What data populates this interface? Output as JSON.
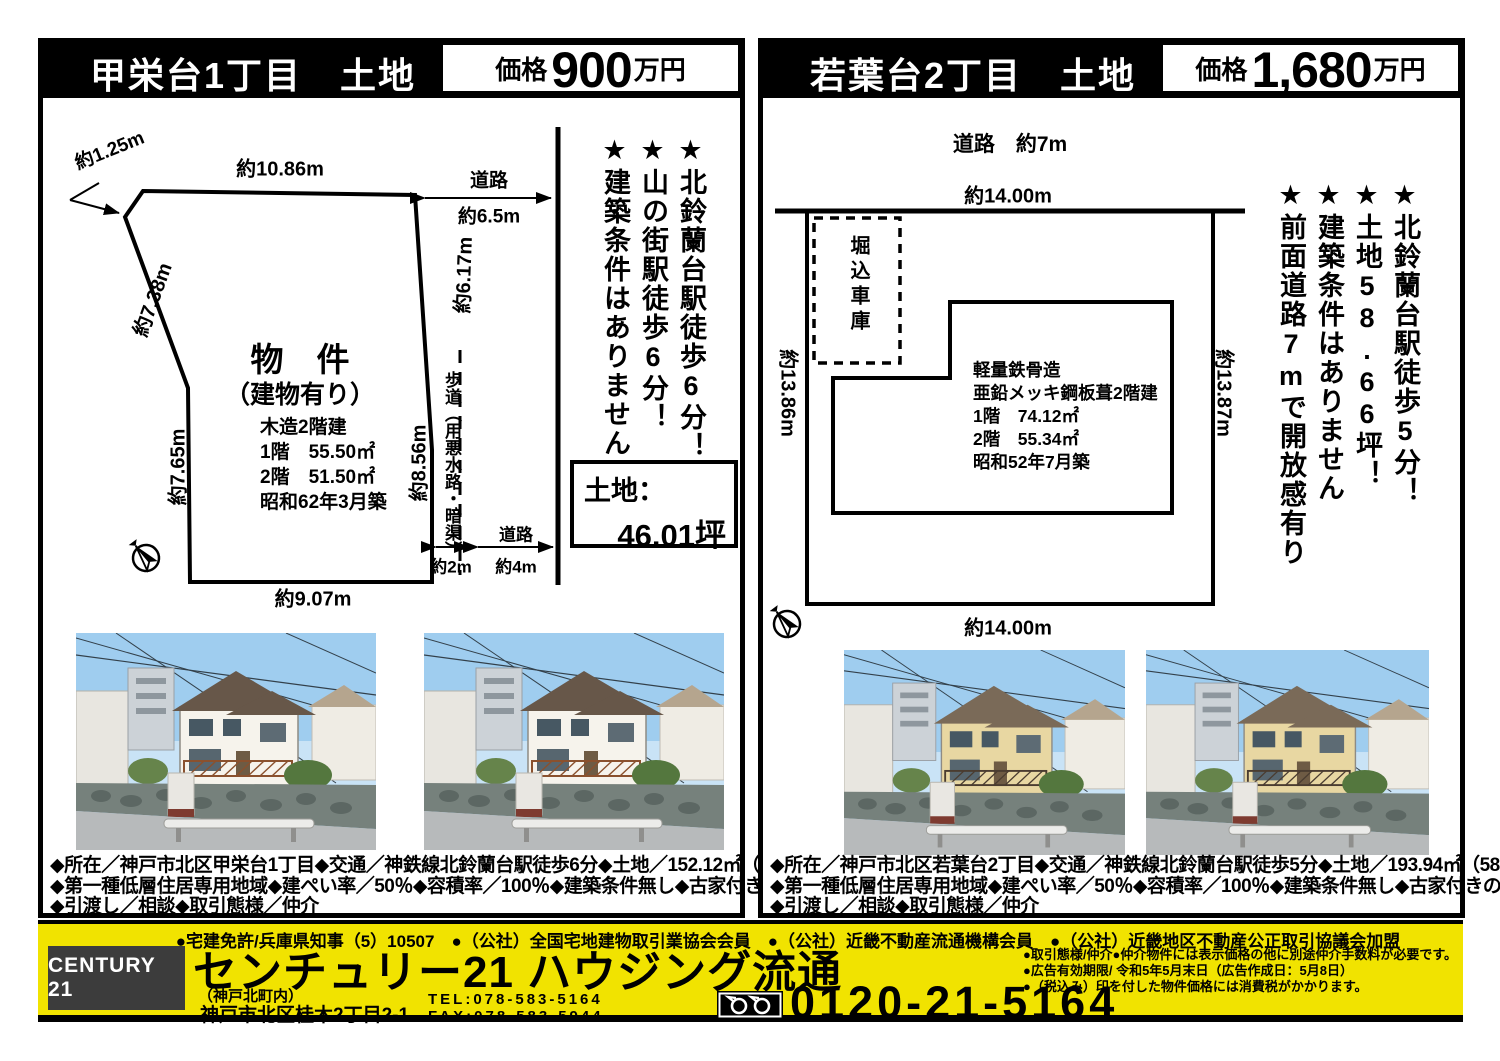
{
  "left_property": {
    "title": "甲栄台1丁目　土地",
    "price": {
      "label": "価格",
      "value": "900",
      "unit": "万円"
    },
    "diagram": {
      "top_width": "約10.86m",
      "corner_width": "約1.25m",
      "left_upper": "約7.38m",
      "left_lower": "約7.65m",
      "right_upper": "約6.17m",
      "right_lower": "約8.56m",
      "bottom_width": "約9.07m",
      "road_right_label": "道路",
      "road_right_width": "約6.5m",
      "sidewalk_label": "歩道（用悪水路・暗渠）",
      "sidewalk_width": "約2m",
      "road_bottom_label": "道路",
      "road_bottom_width": "約4m",
      "lot_title": "物　件",
      "lot_subtitle": "（建物有り）",
      "building_lines": [
        "木造2階建",
        "1階　55.50㎡",
        "2階　51.50㎡",
        "昭和62年3月築"
      ]
    },
    "highlights": [
      "★北鈴蘭台駅徒歩6分！",
      "★山の街駅徒歩6分！",
      "★建築条件はありません"
    ],
    "land_box": {
      "label": "土地：",
      "value": "46.01坪"
    },
    "photo_colors": {
      "house": "#f6f3ec",
      "roof": "#675749",
      "rail": "#8a512e"
    },
    "details": [
      "◆所在／神戸市北区甲栄台1丁目◆交通／神鉄線北鈴蘭台駅徒歩6分◆土地／152.12㎡（46.01坪）",
      "◆第一種低層住居専用地域◆建ぺい率／50％◆容積率／100％◆建築条件無し◆古家付きの引渡し",
      "◆引渡し／相談◆取引態様／仲介"
    ]
  },
  "right_property": {
    "title": "若葉台2丁目　土地",
    "price": {
      "label": "価格",
      "value": "1,680",
      "unit": "万円"
    },
    "diagram": {
      "road_top": "道路　約7m",
      "top_width": "約14.00m",
      "left_side": "約13.86m",
      "right_side": "約13.87m",
      "bottom_width": "約14.00m",
      "garage_label": "堀込車庫",
      "building_lines": [
        "軽量鉄骨造",
        "亜鉛メッキ鋼板葺2階建",
        "1階　74.12㎡",
        "2階　55.34㎡",
        "昭和52年7月築"
      ]
    },
    "highlights": [
      "★北鈴蘭台駅徒歩5分！",
      "★土地58.66坪！",
      "★建築条件はありません",
      "★前面道路7mで開放感有り"
    ],
    "photo_colors": {
      "house": "#e8d7a2",
      "roof": "#7a6a58",
      "rail": "#4a3c30"
    },
    "details": [
      "◆所在／神戸市北区若葉台2丁目◆交通／神鉄線北鈴蘭台駅徒歩5分◆土地／193.94㎡（58.66坪）",
      "◆第一種低層住居専用地域◆建ぺい率／50％◆容積率／100％◆建築条件無し◆古家付きの引渡し",
      "◆引渡し／相談◆取引態様／仲介"
    ]
  },
  "footer": {
    "memberships": "●宅建免許/兵庫県知事（5）10507　●（公社）全国宅地建物取引業協会会員　●（公社）近畿不動産流通機構会員　●（公社）近畿地区不動産公正取引協議会加盟",
    "logo": "CENTURY 21",
    "company": "センチュリー21 ハウジング流通",
    "branch": "（神戸北町内）",
    "address": "神戸市北区桂木2丁目2-1",
    "tel": "TEL:078-583-5164",
    "fax": "FAX:078-583-5944",
    "freedial": "0120-21-5164",
    "notes": [
      "●取引態様/仲介●仲介物件には表示価格の他に別途仲介手数料が必要です。",
      "●広告有効期限/ 令和5年5月末日（広告作成日：5月8日）",
      "●（税込み）印を付した物件価格には消費税がかかります。"
    ]
  }
}
